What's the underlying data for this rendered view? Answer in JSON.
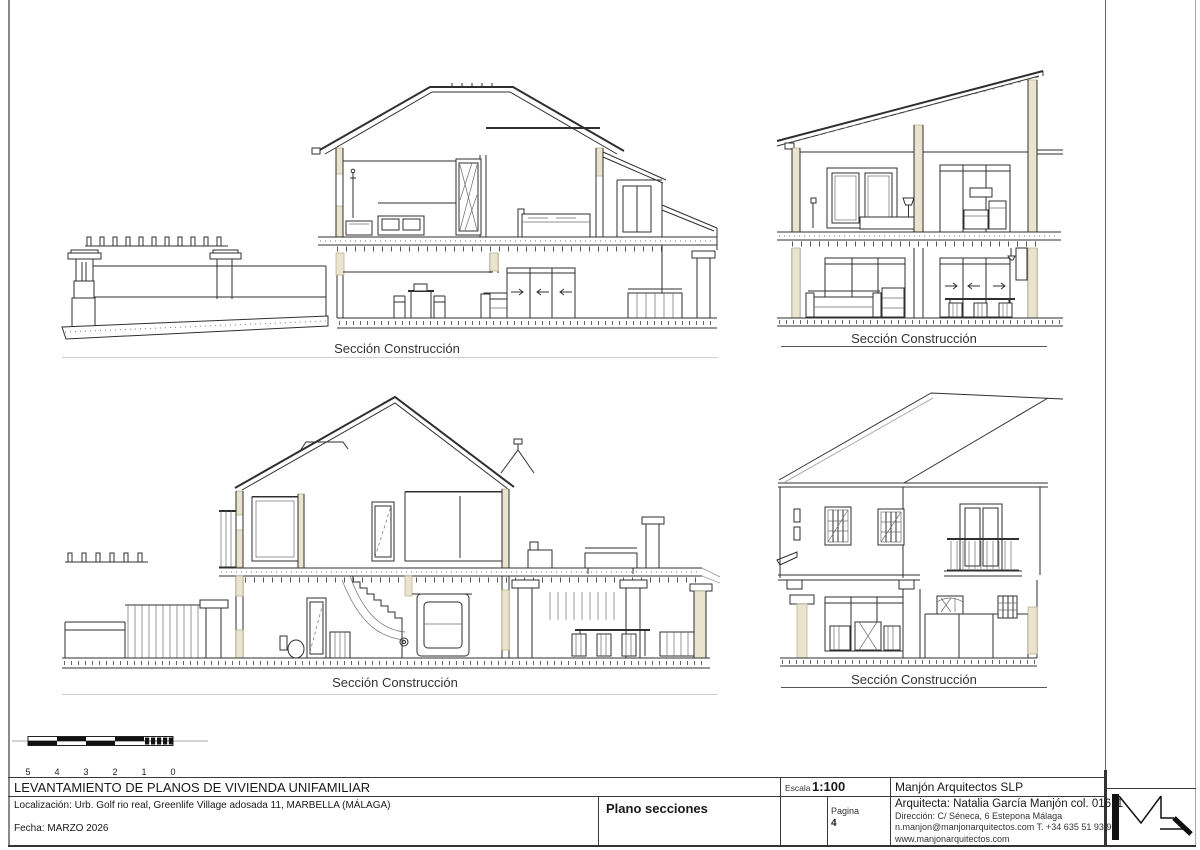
{
  "colors": {
    "cut_wall": "#eae3cd",
    "line": "#2f2f2f",
    "border_gray": "#8a8a8a"
  },
  "drawings": [
    {
      "id": "top-left",
      "label": "Sección Construcción"
    },
    {
      "id": "top-right",
      "label": "Sección Construcción"
    },
    {
      "id": "bottom-left",
      "label": "Sección Construcción"
    },
    {
      "id": "bottom-right",
      "label": "Sección Construcción"
    }
  ],
  "scale_bar": {
    "labels": [
      "5",
      "4",
      "3",
      "2",
      "1",
      "0"
    ]
  },
  "title_block": {
    "project_title": "LEVANTAMIENTO DE PLANOS DE VIVIENDA UNIFAMILIAR",
    "location": "Localización:  Urb. Golf rio real, Greenlife Village adosada 11, MARBELLA (MÁLAGA)",
    "date": "Fecha: MARZO 2026",
    "sheet_name": "Plano secciones",
    "scale_label": "Escala",
    "scale_value": "1:100",
    "page_label": "Pagina",
    "page_number": "4",
    "firm_name": "Manjón Arquitectos SLP",
    "architect": "Arquitecta: Natalia García Manjón col. 01611",
    "address": "Dirección: C/ Séneca, 6 Estepona Málaga",
    "contact": "n.manjon@manjonarquitectos.com T. +34 635 51 93 95",
    "website": "www.manjonarquitectos.com",
    "logo_icon": "m-zigzag-monogram"
  }
}
